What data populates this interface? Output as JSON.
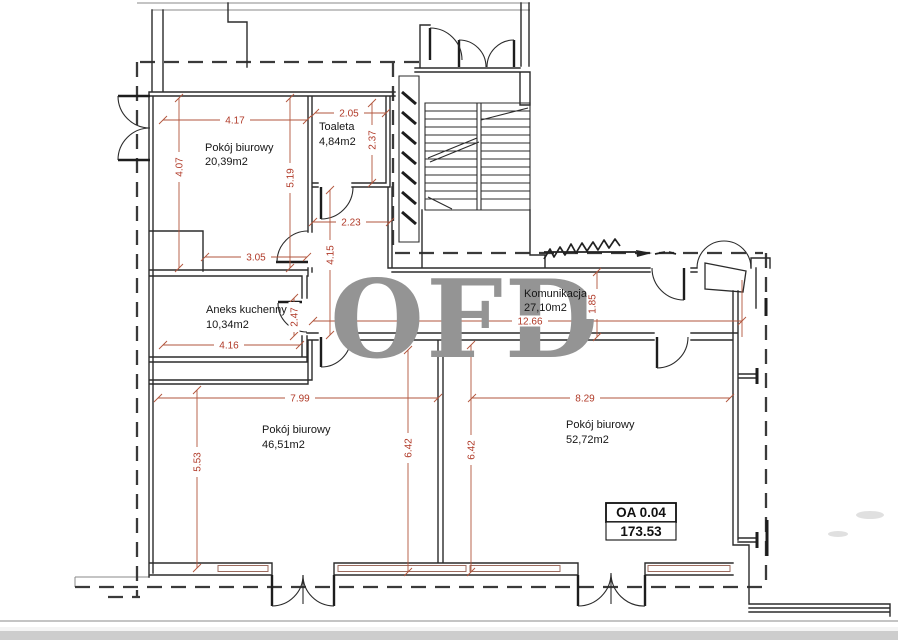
{
  "watermark": {
    "text": "OFD"
  },
  "unit_label": {
    "code": "OA 0.04",
    "area": "173.53"
  },
  "rooms": {
    "office_top": {
      "name": "Pokój biurowy",
      "area": "20,39m2"
    },
    "toilet": {
      "name": "Toaleta",
      "area": "4,84m2"
    },
    "kitchenette": {
      "name": "Aneks kuchenny",
      "area": "10,34m2"
    },
    "hallway": {
      "name": "Komunikacja",
      "area": "27,10m2"
    },
    "office_left": {
      "name": "Pokój biurowy",
      "area": "46,51m2"
    },
    "office_right": {
      "name": "Pokój biurowy",
      "area": "52,72m2"
    }
  },
  "dimensions": {
    "office_top_width": "4.17",
    "office_top_height_left": "4.07",
    "office_top_height_right": "5.19",
    "office_top_bottom": "3.05",
    "toilet_width": "2.05",
    "toilet_height": "2.37",
    "corridor_width": "2.23",
    "corridor_height": "4.15",
    "kitchenette_width": "4.16",
    "kitchenette_height": "2.47",
    "hallway_length": "12.66",
    "hallway_width": "1.85",
    "office_left_width": "7.99",
    "office_left_height": "5.53",
    "office_left_height_right": "6.42",
    "office_right_height_left": "6.42",
    "office_right_width": "8.29"
  },
  "colors": {
    "dimension_line": "#b2553c",
    "dimension_text": "#b03a28",
    "wall": "#2b2b2b",
    "watermark": "#949494"
  }
}
